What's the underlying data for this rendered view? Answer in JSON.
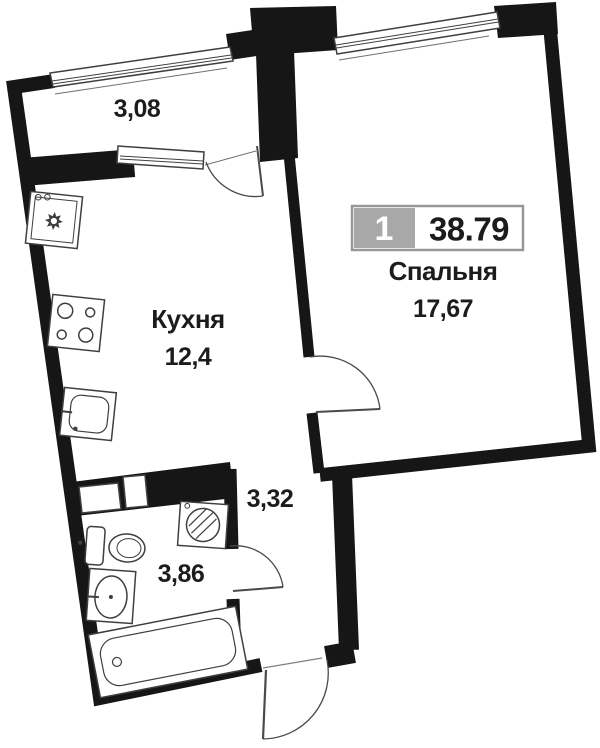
{
  "plan": {
    "badge": {
      "flat_number": "1",
      "total_area": "38.79"
    },
    "rooms": {
      "balcony": {
        "area": "3,08"
      },
      "kitchen": {
        "name": "Кухня",
        "area": "12,4"
      },
      "bedroom": {
        "name": "Спальня",
        "area": "17,67"
      },
      "hallway": {
        "area": "3,32"
      },
      "bathroom": {
        "area": "3,86"
      }
    },
    "icons": {
      "vent_shaft": "vent-shaft-icon",
      "stove": "stove-icon",
      "kitchen_sink": "kitchen-sink-icon",
      "toilet": "toilet-icon",
      "washbasin": "washbasin-icon",
      "washing_machine": "washing-machine-icon",
      "bathtub": "bathtub-icon",
      "window": "window-icon",
      "door_arc": "door-arc-icon"
    },
    "colors": {
      "wall": "#161616",
      "fixture_line": "#3f3f3f",
      "badge_gray": "#a8a8a8",
      "badge_border": "#979797",
      "text": "#1c1c1c",
      "bg": "#ffffff"
    }
  }
}
